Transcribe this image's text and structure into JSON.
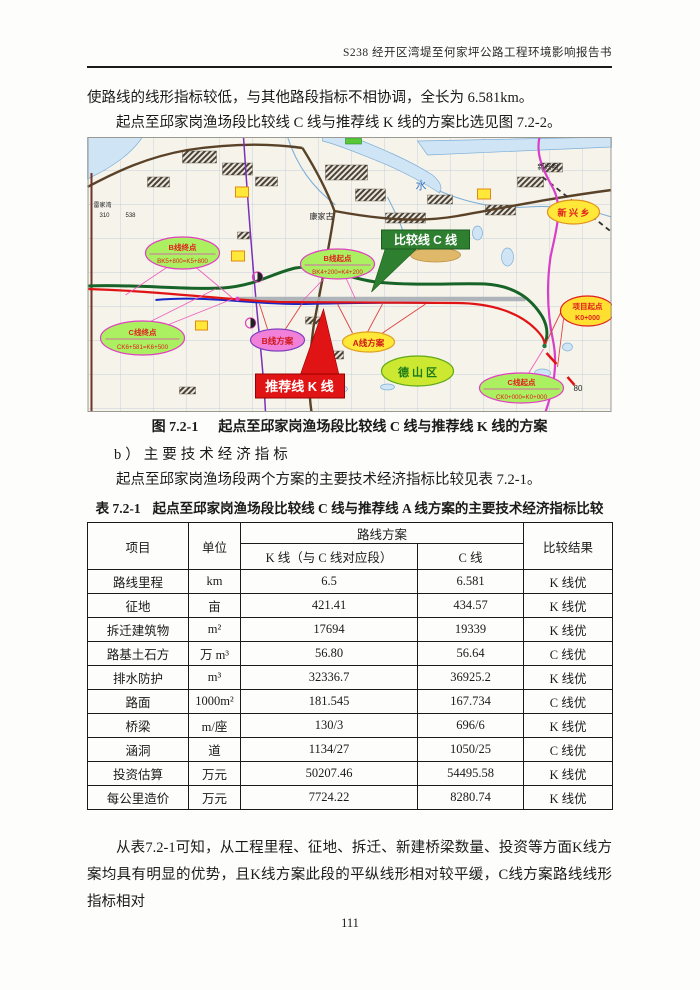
{
  "header": {
    "title": "S238 经开区湾堤至何家坪公路工程环境影响报告书"
  },
  "paragraphs": {
    "p1": "使路线的线形指标较低，与其他路段指标不相协调，全长为 6.581km。",
    "p2": "起点至邱家岗渔场段比较线 C 线与推荐线 K 线的方案比选见图 7.2-2。",
    "p3": "起点至邱家岗渔场段两个方案的主要技术经济指标比较见表 7.2-1。",
    "p4": "从表7.2-1可知，从工程里程、征地、拆迁、新建桥梁数量、投资等方面K线方案均具有明显的优势，且K线方案此段的平纵线形相对较平缓，C线方案路线线形指标相对"
  },
  "figure": {
    "caption_label": "图 7.2-1",
    "caption_title": "起点至邱家岗渔场段比较线 C 线与推荐线 K 线的方案"
  },
  "section_b": {
    "label": "b）主要技术经济指标"
  },
  "table": {
    "title_label": "表 7.2-1",
    "title": "起点至邱家岗渔场段比较线 C 线与推荐线 A 线方案的主要技术经济指标比较",
    "headers": {
      "item": "项目",
      "unit": "单位",
      "scheme_group": "路线方案",
      "k_line": "K 线（与 C 线对应段）",
      "c_line": "C 线",
      "result": "比较结果"
    },
    "rows": [
      {
        "item": "路线里程",
        "unit": "km",
        "k": "6.5",
        "c": "6.581",
        "result": "K 线优"
      },
      {
        "item": "征地",
        "unit": "亩",
        "k": "421.41",
        "c": "434.57",
        "result": "K 线优"
      },
      {
        "item": "拆迁建筑物",
        "unit": "m²",
        "k": "17694",
        "c": "19339",
        "result": "K 线优"
      },
      {
        "item": "路基土石方",
        "unit": "万 m³",
        "k": "56.80",
        "c": "56.64",
        "result": "C 线优"
      },
      {
        "item": "排水防护",
        "unit": "m³",
        "k": "32336.7",
        "c": "36925.2",
        "result": "K 线优"
      },
      {
        "item": "路面",
        "unit": "1000m²",
        "k": "181.545",
        "c": "167.734",
        "result": "C 线优"
      },
      {
        "item": "桥梁",
        "unit": "m/座",
        "k": "130/3",
        "c": "696/6",
        "result": "K 线优"
      },
      {
        "item": "涵洞",
        "unit": "道",
        "k": "1134/27",
        "c": "1050/25",
        "result": "C 线优"
      },
      {
        "item": "投资估算",
        "unit": "万元",
        "k": "50207.46",
        "c": "54495.58",
        "result": "K 线优"
      },
      {
        "item": "每公里造价",
        "unit": "万元",
        "k": "7724.22",
        "c": "8280.74",
        "result": "K 线优"
      }
    ]
  },
  "map": {
    "banners": {
      "c_line": "比较线 C 线",
      "k_line": "推荐线 K 线"
    },
    "ellipses": {
      "b_end": {
        "line1": "B线终点",
        "line2": "BK5+800=K5+800"
      },
      "b_start": {
        "line1": "B线起点",
        "line2": "BK4+200=K4+200"
      },
      "c_end": {
        "line1": "C线终点",
        "line2": "CK6+581=K6+500"
      },
      "c_start": {
        "line1": "C线起点",
        "line2": "CK0+000=K0+000"
      },
      "b_scheme": "B线方案",
      "a_scheme": "A线方案",
      "deshan": "德 山 区",
      "xinxing": "新 兴 乡",
      "proj_start": {
        "line1": "项目起点",
        "line2": "K0+000"
      }
    },
    "labels": {
      "kangjiagu": "康家古",
      "shui": "水",
      "xinxingju": "新兴咀",
      "leijiawan": "雷家湾",
      "n310": "310",
      "n538": "538",
      "n80": "80"
    },
    "colors": {
      "banner_c_green": "#2e8030",
      "banner_k_red": "#e01414",
      "route_red": "#e01414",
      "route_green": "#186428",
      "route_blue": "#1828c8",
      "magenta_road": "#d83ec8",
      "label_green_fill": "#aaf060",
      "label_pink_fill": "#f080d8",
      "label_yellow_fill": "#ffe838",
      "deshan_fill": "#cce830",
      "proj_fill": "#ffe030"
    }
  },
  "page_number": "111"
}
